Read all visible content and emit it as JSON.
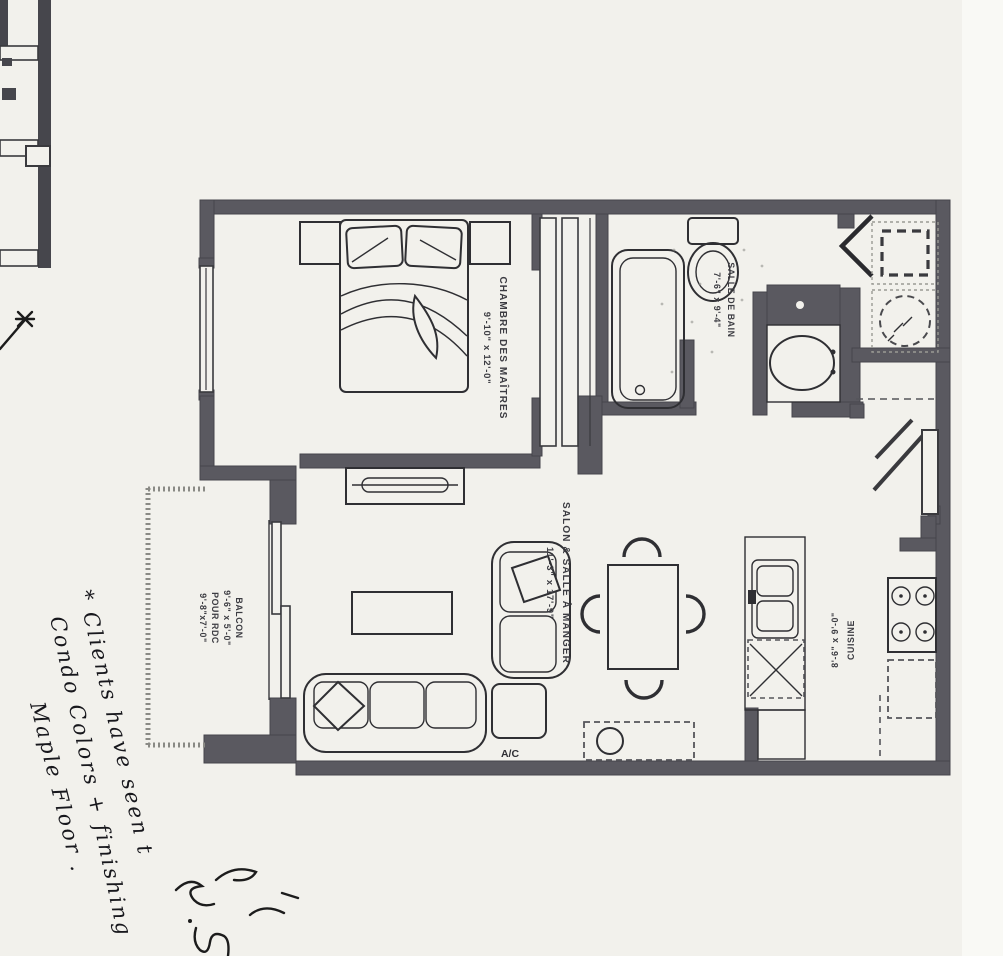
{
  "scan": {
    "kind": "condo-floor-plan-scan",
    "colors": {
      "paper": "#f2f1ec",
      "wall": "#5a5960",
      "furniture_line": "#2f2f33",
      "pen_ink": "#1c1c1c"
    }
  },
  "rooms": {
    "bedroom": {
      "name": "CHAMBRE DES MAÎTRES",
      "dims": "9'-10\" x 12'-0\""
    },
    "bathroom": {
      "name": "SALLE DE BAIN",
      "dims": "7'-6\" x 9'-4\""
    },
    "living_dining": {
      "name": "SALON & SALLE À MANGER",
      "dims": "11'-3\" x 17'-9\""
    },
    "kitchen": {
      "name": "CUISINE",
      "dims": "8'-6\" x 9'-0\""
    },
    "balcony": {
      "name": "BALCON",
      "dims": "9'-6\" x 5'-0\"",
      "note": "POUR RDC",
      "alt_dims": "9'-8\"x7'-0\""
    }
  },
  "labels": {
    "ac_unit": "A/C"
  },
  "handwriting": {
    "line1": "* Clients have seen t",
    "line2": "Condo Colors + finishing",
    "line3": "Maple Floor ."
  }
}
